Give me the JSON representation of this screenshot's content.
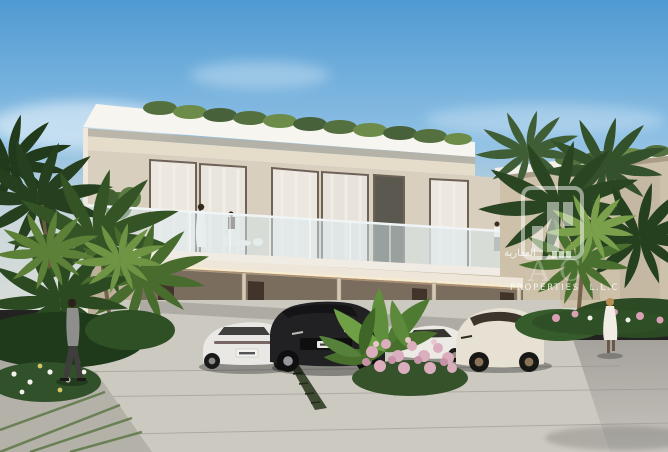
{
  "scene": {
    "subject": "Modern two-storey beige townhouses with carport, four luxury cars, tropical palms, flower beds and pedestrians under a blue sky"
  },
  "watermark": {
    "arabic_text": "العقارية",
    "brand_letters": "AC",
    "properties_text": "PROPERTIES L.L.C"
  },
  "palette": {
    "sky_top": "#4f9ad2",
    "sky_mid": "#8ec0e4",
    "sky_horizon": "#cdd8dc",
    "roof": "#f7f5f0",
    "facade_upper": "#d9cfbf",
    "facade_band": "#e6dcca",
    "facade_lower": "#bdb09b",
    "right_building": "#cdc1aa",
    "greenery_dark": "#26401f",
    "greenery_mid": "#355426",
    "greenery_light": "#6f9444",
    "road": "#b4b1ab",
    "driveway": "#ccc9c1",
    "car_white": "#e9e8e4",
    "car_black": "#212124",
    "car_sport": "#eceae4",
    "car_cream": "#e7e1d3",
    "flowers_pink": "#dbaebd",
    "suit_gray": "#8e8e8c",
    "dress_white": "#f1ede4"
  }
}
